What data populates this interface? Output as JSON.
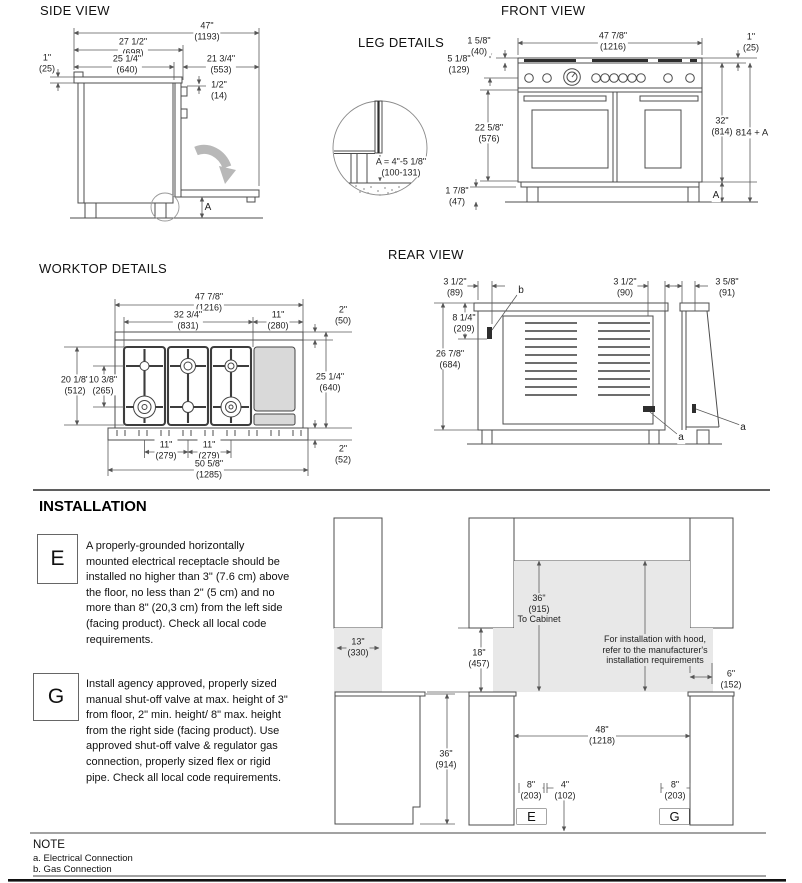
{
  "page_titles": {
    "side": "SIDE VIEW",
    "front": "FRONT VIEW",
    "leg": "LEG DETAILS",
    "worktop": "WORKTOP DETAILS",
    "rear": "REAR VIEW",
    "installation": "INSTALLATION"
  },
  "side_view": {
    "dims": {
      "total_width": "47\"\n(1193)",
      "depth_top": "27 1/2\"\n(698)",
      "depth_body": "25 1/4\"\n(640)",
      "door_depth": "21 3/4\"\n(553)",
      "worktop_thickness": "1\"\n(25)",
      "gap": "1/2\"\n(14)",
      "leg_letter": "A"
    }
  },
  "front_view": {
    "dims": {
      "grate_height": "1 5/8\"\n(40)",
      "panel_height": "5 1/8\"\n(129)",
      "width": "47 7/8\"\n(1216)",
      "grate_offset": "1\"\n(25)",
      "door_height": "22 5/8\"\n(576)",
      "leg_height": "1 7/8\"\n(47)",
      "body_height": "32\"\n(814)",
      "total_height": "814 + A",
      "leg_letter": "A"
    }
  },
  "leg_details": {
    "formula": "A = 4\"-5 1/8\"\n(100-131)"
  },
  "worktop": {
    "dims": {
      "width": "47 7/8\"\n(1216)",
      "burner_area": "32 3/4\"\n(831)",
      "griddle_width": "11\"\n(280)",
      "front_edge": "2\"\n(50)",
      "grate_depth": "20 1/8\"\n(512)",
      "burner_row_spacing": "10 3/8\"\n(265)",
      "depth": "25 1/4\"\n(640)",
      "burner_spacing_1": "11\"\n(279)",
      "burner_spacing_2": "11\"\n(279)",
      "base_edge": "2\"\n(52)",
      "total_width": "50 5/8\"\n(1285)"
    }
  },
  "rear_view": {
    "dims": {
      "elec_offset": "3 1/2\"\n(89)",
      "elec_height": "8 1/4\"\n(209)",
      "height": "26 7/8\"\n(684)",
      "gas_offset": "3 1/2\"\n(90)",
      "side_offset": "3 5/8\"\n(91)",
      "label_b": "b",
      "label_a1": "a",
      "label_a2": "a"
    }
  },
  "installation": {
    "e_label": "E",
    "e_text": "A properly-grounded horizontally\nmounted electrical receptacle should be\ninstalled no higher than 3\" (7.6 cm) above\nthe floor, no less than 2\" (5 cm) and no\nmore than 8\" (20,3 cm) from the left side\n(facing product). Check all local code\nrequirements.",
    "g_label": "G",
    "g_text": "Install agency approved, properly sized\nmanual shut-off valve at max. height of 3\"\nfrom floor, 2\" min. height/ 8\" max. height\nfrom the right side (facing product). Use\napproved shut-off valve & regulator gas\nconnection, properly sized flex or rigid\npipe. Check all local code requirements.",
    "left_diagram": {
      "recess_width": "13\"\n(330)",
      "counter_height": "36\"\n(914)",
      "clearance": "18\"\n(457)"
    },
    "right_diagram": {
      "to_cabinet": "36\"\n(915)\nTo Cabinet",
      "hood_note": "For installation with hood,\nrefer to the manufacturer's\ninstallation requirements",
      "side_clearance": "6\"\n(152)",
      "opening_width": "48\"\n(1218)",
      "elec_offset": "8\"\n(203)",
      "gas_center": "4\"\n(102)",
      "gas_offset": "8\"\n(203)",
      "e_label": "E",
      "g_label": "G"
    }
  },
  "note": {
    "title": "NOTE",
    "items": [
      "a. Electrical Connection",
      "b. Gas Connection"
    ]
  }
}
